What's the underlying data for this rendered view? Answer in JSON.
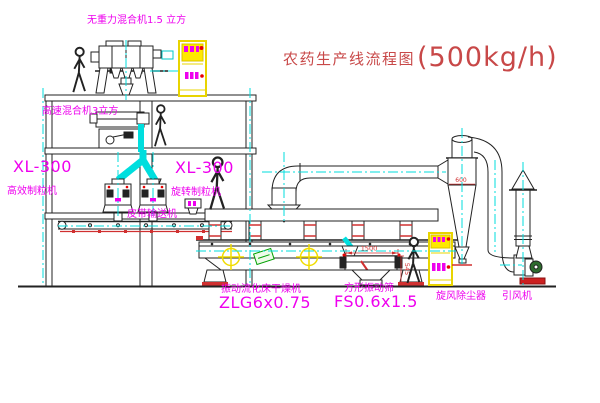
{
  "title": {
    "cn": "农药生产线流程图",
    "capacity": "(500kg/h)"
  },
  "labels": {
    "top_mixer": "无重力混合机1.5 立方",
    "mid_mixer": "高速混合机3立方",
    "granulator_left_model": "XL-300",
    "granulator_left_name": "高效制粒机",
    "granulator_right_model": "XL-300",
    "granulator_right_name": "旋转制粒机",
    "conveyor": "皮带输送机",
    "dryer_name": "振动流化床干燥机",
    "dryer_model": "ZLG6x0.75",
    "sieve_name": "方形振动筛",
    "sieve_model": "FS0.6x1.5",
    "cyclone": "旋风除尘器",
    "fan": "引风机"
  },
  "dimensions": {
    "sieve_width": "1500",
    "sieve_height": "545",
    "cyclone_marking": "600"
  },
  "colors": {
    "line": "#222222",
    "centerline_cyan": "#00dede",
    "label_magenta": "#ee00ee",
    "title_red": "#c84848",
    "dim_red": "#d03030",
    "equipment_yellow": "#f0dc00",
    "tag_green": "#00a000"
  }
}
